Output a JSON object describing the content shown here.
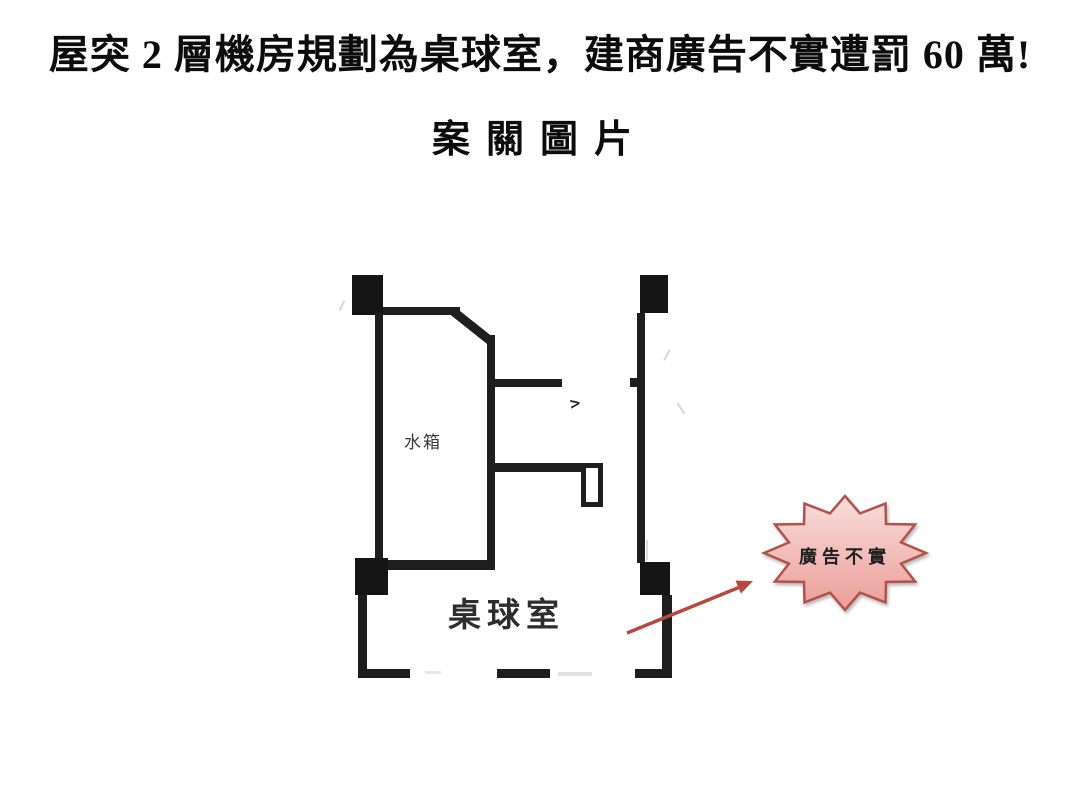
{
  "page": {
    "title": "屋突 2 層機房規劃為桌球室，建商廣告不實遭罰 60 萬!",
    "subtitle": "案關圖片",
    "background": "#ffffff",
    "title_color": "#0c0c0c"
  },
  "floor_plan": {
    "wall_color": "#1e1e1e",
    "rooms": [
      {
        "id": "water-tank-room",
        "label": "水箱"
      },
      {
        "id": "table-tennis-room",
        "label": "桌球室"
      }
    ],
    "door_marker": ">"
  },
  "annotation": {
    "burst_label": "廣告不實",
    "burst_fill_top": "#f8dedc",
    "burst_fill_bottom": "#ec9d98",
    "burst_border": "#b0524c",
    "arrow_color": "#b5493f",
    "label_color": "#1f1f1f"
  }
}
